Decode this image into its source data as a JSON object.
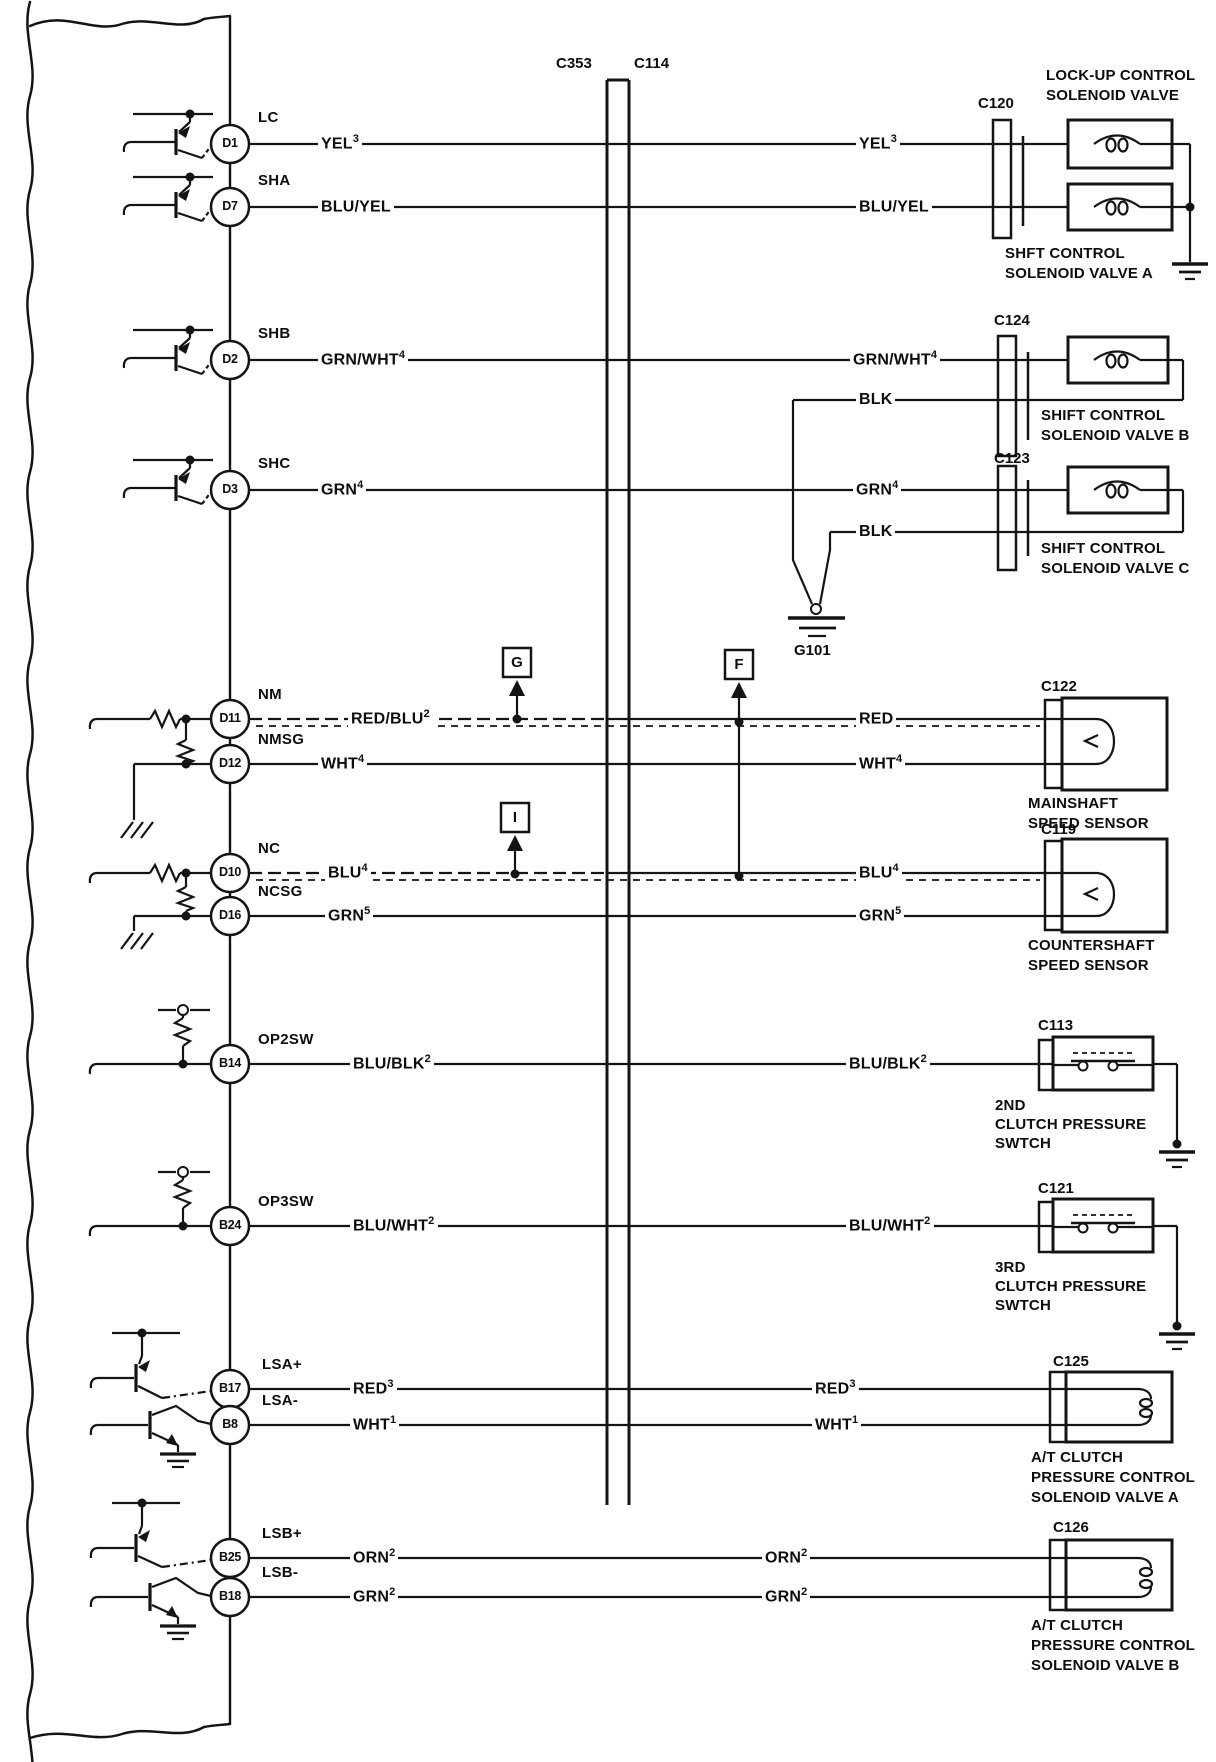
{
  "connector_center": {
    "left_id": "C353",
    "right_id": "C114"
  },
  "labels": {
    "blk": "BLK",
    "g101": "G101",
    "ref_g": "G",
    "ref_f": "F",
    "ref_i": "I"
  },
  "rows": [
    {
      "pin": "D1",
      "signal": "LC",
      "left": {
        "text": "YEL",
        "sup": "3"
      },
      "right": {
        "text": "YEL",
        "sup": "3"
      }
    },
    {
      "pin": "D7",
      "signal": "SHA",
      "left": {
        "text": "BLU/YEL",
        "sup": ""
      },
      "right": {
        "text": "BLU/YEL",
        "sup": ""
      }
    },
    {
      "pin": "D2",
      "signal": "SHB",
      "left": {
        "text": "GRN/WHT",
        "sup": "4"
      },
      "right": {
        "text": "GRN/WHT",
        "sup": "4"
      }
    },
    {
      "pin": "D3",
      "signal": "SHC",
      "left": {
        "text": "GRN",
        "sup": "4"
      },
      "right": {
        "text": "GRN",
        "sup": "4"
      }
    },
    {
      "pin": "D11",
      "signal": "NM",
      "left": {
        "text": "RED/BLU",
        "sup": "2"
      },
      "right": {
        "text": "RED",
        "sup": ""
      }
    },
    {
      "pin": "D12",
      "signal": "NMSG",
      "left": {
        "text": "WHT",
        "sup": "4"
      },
      "right": {
        "text": "WHT",
        "sup": "4"
      }
    },
    {
      "pin": "D10",
      "signal": "NC",
      "left": {
        "text": "BLU",
        "sup": "4"
      },
      "right": {
        "text": "BLU",
        "sup": "4"
      }
    },
    {
      "pin": "D16",
      "signal": "NCSG",
      "left": {
        "text": "GRN",
        "sup": "5"
      },
      "right": {
        "text": "GRN",
        "sup": "5"
      }
    },
    {
      "pin": "B14",
      "signal": "OP2SW",
      "left": {
        "text": "BLU/BLK",
        "sup": "2"
      },
      "right": {
        "text": "BLU/BLK",
        "sup": "2"
      }
    },
    {
      "pin": "B24",
      "signal": "OP3SW",
      "left": {
        "text": "BLU/WHT",
        "sup": "2"
      },
      "right": {
        "text": "BLU/WHT",
        "sup": "2"
      }
    },
    {
      "pin": "B17",
      "signal": "LSA+",
      "left": {
        "text": "RED",
        "sup": "3"
      },
      "right": {
        "text": "RED",
        "sup": "3"
      }
    },
    {
      "pin": "B8",
      "signal": "LSA-",
      "left": {
        "text": "WHT",
        "sup": "1"
      },
      "right": {
        "text": "WHT",
        "sup": "1"
      }
    },
    {
      "pin": "B25",
      "signal": "LSB+",
      "left": {
        "text": "ORN",
        "sup": "2"
      },
      "right": {
        "text": "ORN",
        "sup": "2"
      }
    },
    {
      "pin": "B18",
      "signal": "LSB-",
      "left": {
        "text": "GRN",
        "sup": "2"
      },
      "right": {
        "text": "GRN",
        "sup": "2"
      }
    }
  ],
  "components": {
    "c120": {
      "id": "C120",
      "title": [
        "LOCK-UP CONTROL",
        "SOLENOID VALVE"
      ],
      "subtitle": [
        "SHFT CONTROL",
        "SOLENOID VALVE A"
      ]
    },
    "c124": {
      "id": "C124",
      "title": [
        "SHIFT CONTROL",
        "SOLENOID VALVE B"
      ]
    },
    "c123": {
      "id": "C123",
      "title": [
        "SHIFT CONTROL",
        "SOLENOID VALVE C"
      ]
    },
    "c122": {
      "id": "C122",
      "title": [
        "MAINSHAFT",
        "SPEED SENSOR"
      ]
    },
    "c119": {
      "id": "C119",
      "title": [
        "COUNTERSHAFT",
        "SPEED SENSOR"
      ]
    },
    "c113": {
      "id": "C113",
      "title": [
        "2ND",
        "CLUTCH PRESSURE",
        "SWTCH"
      ]
    },
    "c121": {
      "id": "C121",
      "title": [
        "3RD",
        "CLUTCH PRESSURE",
        "SWTCH"
      ]
    },
    "c125": {
      "id": "C125",
      "title": [
        "A/T CLUTCH",
        "PRESSURE CONTROL",
        "SOLENOID VALVE A"
      ]
    },
    "c126": {
      "id": "C126",
      "title": [
        "A/T CLUTCH",
        "PRESSURE CONTROL",
        "SOLENOID VALVE B"
      ]
    }
  },
  "colors": {
    "ink": "#141414",
    "paper": "#ffffff"
  }
}
